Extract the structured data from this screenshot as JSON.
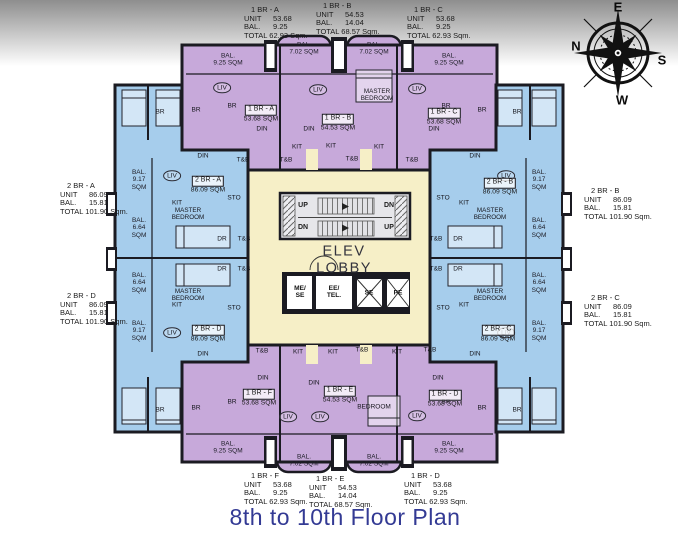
{
  "title": "8th to 10th Floor Plan",
  "lobby": {
    "text": "ELEV\nLOBBY"
  },
  "compass": {
    "top": "E",
    "left": "N",
    "right": "S",
    "bottom": "W"
  },
  "labels": {
    "unit": "UNIT",
    "bal": "BAL.",
    "total": "TOTAL",
    "sqm_suffix": "Sqm."
  },
  "colors": {
    "one_br": "#c7a9da",
    "two_br": "#a6cdec",
    "lobby": "#f6efc7",
    "wall": "#1b1b22",
    "title": "#333a94",
    "text": "#1b1b1b"
  },
  "info_blocks": [
    {
      "name": "1 BR - A",
      "unit": "53.68",
      "bal": "9.25",
      "total": "62.93",
      "x": 244,
      "y": 6
    },
    {
      "name": "1 BR - B",
      "unit": "54.53",
      "bal": "14.04",
      "total": "68.57",
      "x": 316,
      "y": 2
    },
    {
      "name": "1 BR - C",
      "unit": "53.68",
      "bal": "9.25",
      "total": "62.93",
      "x": 407,
      "y": 6
    },
    {
      "name": "2 BR - A",
      "unit": "86.09",
      "bal": "15.81",
      "total": "101.90",
      "x": 60,
      "y": 182
    },
    {
      "name": "2 BR - B",
      "unit": "86.09",
      "bal": "15.81",
      "total": "101.90",
      "x": 584,
      "y": 187
    },
    {
      "name": "2 BR - D",
      "unit": "86.09",
      "bal": "15.81",
      "total": "101.90",
      "x": 60,
      "y": 292
    },
    {
      "name": "2 BR - C",
      "unit": "86.09",
      "bal": "15.81",
      "total": "101.90",
      "x": 584,
      "y": 294
    },
    {
      "name": "1 BR - F",
      "unit": "53.68",
      "bal": "9.25",
      "total": "62.93",
      "x": 244,
      "y": 472
    },
    {
      "name": "1 BR - E",
      "unit": "54.53",
      "bal": "14.04",
      "total": "68.57",
      "x": 309,
      "y": 475
    },
    {
      "name": "1 BR - D",
      "unit": "53.68",
      "bal": "9.25",
      "total": "62.93",
      "x": 404,
      "y": 472
    }
  ],
  "unit_tags": [
    {
      "name": "1 BR - A",
      "sqm": "53.68 SQM",
      "x": 261,
      "y": 111
    },
    {
      "name": "1 BR - B",
      "sqm": "54.53 SQM",
      "x": 338,
      "y": 120
    },
    {
      "name": "1 BR - C",
      "sqm": "53.68 SQM",
      "x": 444,
      "y": 114
    },
    {
      "name": "2 BR - A",
      "sqm": "86.09 SQM",
      "x": 208,
      "y": 182
    },
    {
      "name": "2 BR - B",
      "sqm": "86.09 SQM",
      "x": 500,
      "y": 184
    },
    {
      "name": "2 BR - D",
      "sqm": "86.09 SQM",
      "x": 208,
      "y": 331
    },
    {
      "name": "2 BR - C",
      "sqm": "86.09 SQM",
      "x": 498,
      "y": 331
    },
    {
      "name": "1 BR - F",
      "sqm": "53.68 SQM",
      "x": 259,
      "y": 395
    },
    {
      "name": "1 BR - E",
      "sqm": "54.53 SQM",
      "x": 340,
      "y": 392
    },
    {
      "name": "1 BR - D",
      "sqm": "53.68 SQM",
      "x": 445,
      "y": 396
    }
  ],
  "balcony_labels": [
    {
      "text": "BAL.\n9.25 SQM",
      "x": 228,
      "y": 60
    },
    {
      "text": "BAL.\n7.02 SQM",
      "x": 304,
      "y": 49
    },
    {
      "text": "BAL.\n7.02 SQM",
      "x": 374,
      "y": 49
    },
    {
      "text": "BAL.\n9.25 SQM",
      "x": 449,
      "y": 60
    },
    {
      "text": "BAL.\n9.25 SQM",
      "x": 228,
      "y": 448
    },
    {
      "text": "BAL.\n7.02 SQM",
      "x": 304,
      "y": 461
    },
    {
      "text": "BAL.\n7.02 SQM",
      "x": 374,
      "y": 461
    },
    {
      "text": "BAL.\n9.25 SQM",
      "x": 449,
      "y": 448
    },
    {
      "text": "BAL.\n9.17\nSQM",
      "x": 139,
      "y": 180
    },
    {
      "text": "BAL.\n6.64\nSQM",
      "x": 139,
      "y": 228
    },
    {
      "text": "BAL.\n6.64\nSQM",
      "x": 139,
      "y": 283
    },
    {
      "text": "BAL.\n9.17\nSQM",
      "x": 139,
      "y": 331
    },
    {
      "text": "BAL.\n9.17\nSQM",
      "x": 539,
      "y": 180
    },
    {
      "text": "BAL.\n6.64\nSQM",
      "x": 539,
      "y": 228
    },
    {
      "text": "BAL.\n6.64\nSQM",
      "x": 539,
      "y": 283
    },
    {
      "text": "BAL.\n9.17\nSQM",
      "x": 539,
      "y": 331
    }
  ],
  "room_labels": [
    {
      "t": "BR",
      "x": 160,
      "y": 112
    },
    {
      "t": "BR",
      "x": 196,
      "y": 110
    },
    {
      "t": "BR",
      "x": 232,
      "y": 106
    },
    {
      "t": "LIV",
      "x": 222,
      "y": 88,
      "c": 1
    },
    {
      "t": "DIN",
      "x": 262,
      "y": 129
    },
    {
      "t": "T&B",
      "x": 243,
      "y": 160
    },
    {
      "t": "KIT",
      "x": 297,
      "y": 147
    },
    {
      "t": "LIV",
      "x": 318,
      "y": 90,
      "c": 1
    },
    {
      "t": "DIN",
      "x": 309,
      "y": 129
    },
    {
      "t": "KIT",
      "x": 331,
      "y": 146
    },
    {
      "t": "T&B",
      "x": 286,
      "y": 160
    },
    {
      "t": "MASTER\nBEDROOM",
      "x": 377,
      "y": 95
    },
    {
      "t": "T&B",
      "x": 352,
      "y": 159
    },
    {
      "t": "KIT",
      "x": 379,
      "y": 147
    },
    {
      "t": "LIV",
      "x": 417,
      "y": 89,
      "c": 1
    },
    {
      "t": "DIN",
      "x": 434,
      "y": 129
    },
    {
      "t": "T&B",
      "x": 412,
      "y": 160
    },
    {
      "t": "BR",
      "x": 446,
      "y": 106
    },
    {
      "t": "BR",
      "x": 482,
      "y": 110
    },
    {
      "t": "BR",
      "x": 517,
      "y": 112
    },
    {
      "t": "DIN",
      "x": 203,
      "y": 156
    },
    {
      "t": "LIV",
      "x": 172,
      "y": 176,
      "c": 1
    },
    {
      "t": "STO",
      "x": 234,
      "y": 198
    },
    {
      "t": "KIT",
      "x": 177,
      "y": 203
    },
    {
      "t": "MASTER\nBEDROOM",
      "x": 188,
      "y": 214
    },
    {
      "t": "DR",
      "x": 222,
      "y": 239
    },
    {
      "t": "T&B",
      "x": 244,
      "y": 239
    },
    {
      "t": "DR",
      "x": 222,
      "y": 269
    },
    {
      "t": "T&B",
      "x": 244,
      "y": 269
    },
    {
      "t": "MASTER\nBEDROOM",
      "x": 188,
      "y": 295
    },
    {
      "t": "KIT",
      "x": 177,
      "y": 305
    },
    {
      "t": "STO",
      "x": 234,
      "y": 308
    },
    {
      "t": "LIV",
      "x": 172,
      "y": 333,
      "c": 1
    },
    {
      "t": "DIN",
      "x": 203,
      "y": 354
    },
    {
      "t": "DIN",
      "x": 475,
      "y": 156
    },
    {
      "t": "LIV",
      "x": 506,
      "y": 176,
      "c": 1
    },
    {
      "t": "STO",
      "x": 443,
      "y": 198
    },
    {
      "t": "KIT",
      "x": 464,
      "y": 203
    },
    {
      "t": "MASTER\nBEDROOM",
      "x": 490,
      "y": 214
    },
    {
      "t": "T&B",
      "x": 436,
      "y": 239
    },
    {
      "t": "DR",
      "x": 458,
      "y": 239
    },
    {
      "t": "T&B",
      "x": 436,
      "y": 269
    },
    {
      "t": "DR",
      "x": 458,
      "y": 269
    },
    {
      "t": "MASTER\nBEDROOM",
      "x": 490,
      "y": 295
    },
    {
      "t": "KIT",
      "x": 464,
      "y": 305
    },
    {
      "t": "STO",
      "x": 443,
      "y": 308
    },
    {
      "t": "LIV",
      "x": 506,
      "y": 333,
      "c": 1
    },
    {
      "t": "DIN",
      "x": 475,
      "y": 354
    },
    {
      "t": "T&B",
      "x": 262,
      "y": 351
    },
    {
      "t": "DIN",
      "x": 263,
      "y": 378
    },
    {
      "t": "LIV",
      "x": 288,
      "y": 417,
      "c": 1
    },
    {
      "t": "BR",
      "x": 232,
      "y": 402
    },
    {
      "t": "BR",
      "x": 196,
      "y": 408
    },
    {
      "t": "BR",
      "x": 160,
      "y": 410
    },
    {
      "t": "KIT",
      "x": 298,
      "y": 352
    },
    {
      "t": "KIT",
      "x": 333,
      "y": 352
    },
    {
      "t": "T&B",
      "x": 362,
      "y": 350
    },
    {
      "t": "DIN",
      "x": 314,
      "y": 383
    },
    {
      "t": "LIV",
      "x": 320,
      "y": 417,
      "c": 1
    },
    {
      "t": "BEDROOM",
      "x": 374,
      "y": 407
    },
    {
      "t": "T&B",
      "x": 430,
      "y": 350
    },
    {
      "t": "KIT",
      "x": 397,
      "y": 352
    },
    {
      "t": "DIN",
      "x": 438,
      "y": 378
    },
    {
      "t": "LIV",
      "x": 417,
      "y": 416,
      "c": 1
    },
    {
      "t": "BR",
      "x": 446,
      "y": 402
    },
    {
      "t": "BR",
      "x": 482,
      "y": 408
    },
    {
      "t": "BR",
      "x": 517,
      "y": 410
    }
  ],
  "stair_labels": [
    {
      "t": "UP",
      "x": 303,
      "y": 206
    },
    {
      "t": "DN",
      "x": 389,
      "y": 206
    },
    {
      "t": "DN",
      "x": 303,
      "y": 228
    },
    {
      "t": "UP",
      "x": 389,
      "y": 228
    }
  ],
  "elevator_cells": [
    {
      "label": "ME/\nSE",
      "x": 300,
      "y": 292
    },
    {
      "label": "EE/\nTEL.",
      "x": 334,
      "y": 292
    },
    {
      "label": "SE",
      "x": 369,
      "y": 293
    },
    {
      "label": "PE",
      "x": 398,
      "y": 293
    }
  ]
}
